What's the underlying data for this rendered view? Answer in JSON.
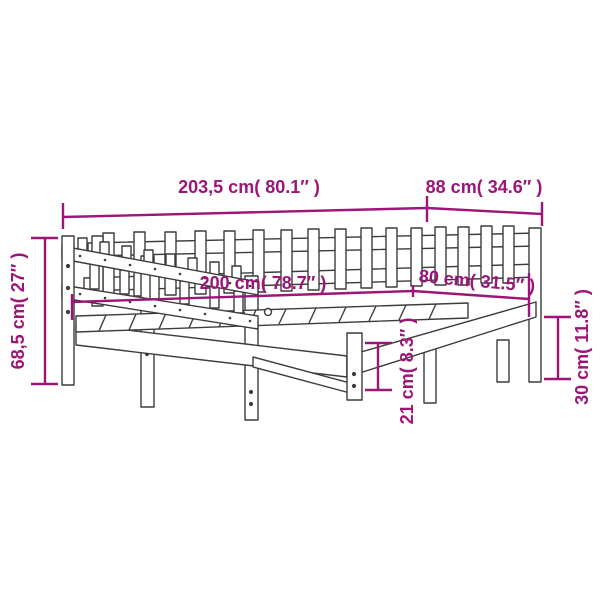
{
  "diagram": {
    "type": "product-dimension-diagram",
    "subject": "daybed-with-slatted-rails",
    "accent_color": "#9C1677",
    "line_color": "#3C3C3B",
    "background_color": "#FFFFFF"
  },
  "dimensions": {
    "total_length": "203,5 cm( 80.1″ )",
    "total_width": "88 cm( 34.6″ )",
    "total_height": "68,5 cm( 27″ )",
    "inner_length": "200 cm( 78.7″ )",
    "inner_width": "80 cm( 31.5″ )",
    "under_bed_clearance": "21 cm( 8.3″ )",
    "base_height": "30 cm( 11.8″ )"
  }
}
